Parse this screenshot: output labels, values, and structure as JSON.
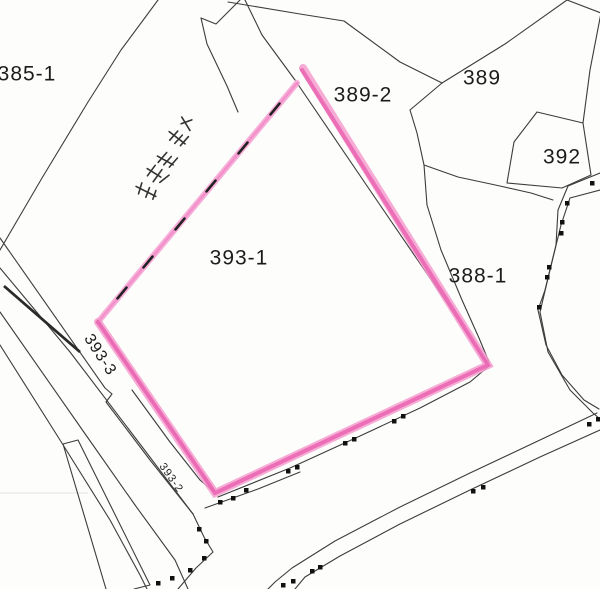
{
  "map": {
    "type": "cadastral-parcel-map",
    "background_color": "#fdfdfc",
    "boundary_color": "#3c3c3c",
    "highlight_color": "#e85faf",
    "highlight_light_color": "#f6a0d2",
    "survey_dot_color": "#111111",
    "highlighted_parcel": "393-1",
    "labels": [
      {
        "id": "385-1",
        "text": "385-1",
        "x": 27,
        "y": 74,
        "size": 21,
        "rotation": 0
      },
      {
        "id": "389-2",
        "text": "389-2",
        "x": 363,
        "y": 95,
        "size": 21,
        "rotation": 0
      },
      {
        "id": "389",
        "text": "389",
        "x": 482,
        "y": 78,
        "size": 21,
        "rotation": 0
      },
      {
        "id": "392",
        "text": "392",
        "x": 562,
        "y": 157,
        "size": 21,
        "rotation": 0
      },
      {
        "id": "393-1",
        "text": "393-1",
        "x": 239,
        "y": 258,
        "size": 21,
        "rotation": 0
      },
      {
        "id": "388-1",
        "text": "388-1",
        "x": 478,
        "y": 276,
        "size": 21,
        "rotation": 0
      },
      {
        "id": "393-3",
        "text": "393-3",
        "x": 100,
        "y": 355,
        "size": 16,
        "rotation": 57
      },
      {
        "id": "393-2",
        "text": "393-2",
        "x": 171,
        "y": 478,
        "size": 11,
        "rotation": 55
      }
    ],
    "handwritten_note_description": "illegible handwritten kanji annotation, rotated"
  }
}
